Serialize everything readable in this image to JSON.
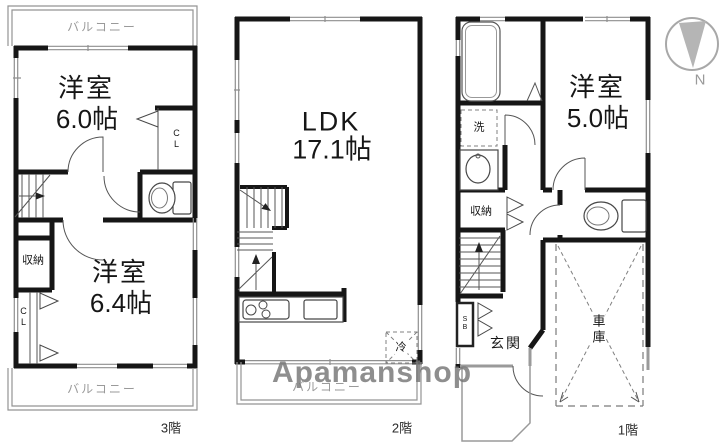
{
  "watermark": {
    "text": "Apamanshop"
  },
  "compass": {
    "label": "N"
  },
  "floor3": {
    "label": "3階",
    "balcony_top": "バルコニー",
    "balcony_bottom": "バルコニー",
    "room1": {
      "name": "洋室",
      "size": "6.0帖"
    },
    "room2": {
      "name": "洋室",
      "size": "6.4帖"
    },
    "storage": "収納",
    "closet_upper": "CL",
    "closet_lower": "CL"
  },
  "floor2": {
    "label": "2階",
    "balcony": "バルコニー",
    "ldk": {
      "name": "LDK",
      "size": "17.1帖"
    },
    "refrigerator": "冷"
  },
  "floor1": {
    "label": "1階",
    "room": {
      "name": "洋室",
      "size": "5.0帖"
    },
    "laundry": "洗",
    "storage": "収納",
    "shoe_box": "SB",
    "entrance": "玄関",
    "garage": "車庫"
  },
  "colors": {
    "wall": "#161616",
    "window_line": "#8f8f8f",
    "balcony_line": "#949494",
    "watermark": "#767676",
    "gray_text": "#9a9a9a"
  }
}
